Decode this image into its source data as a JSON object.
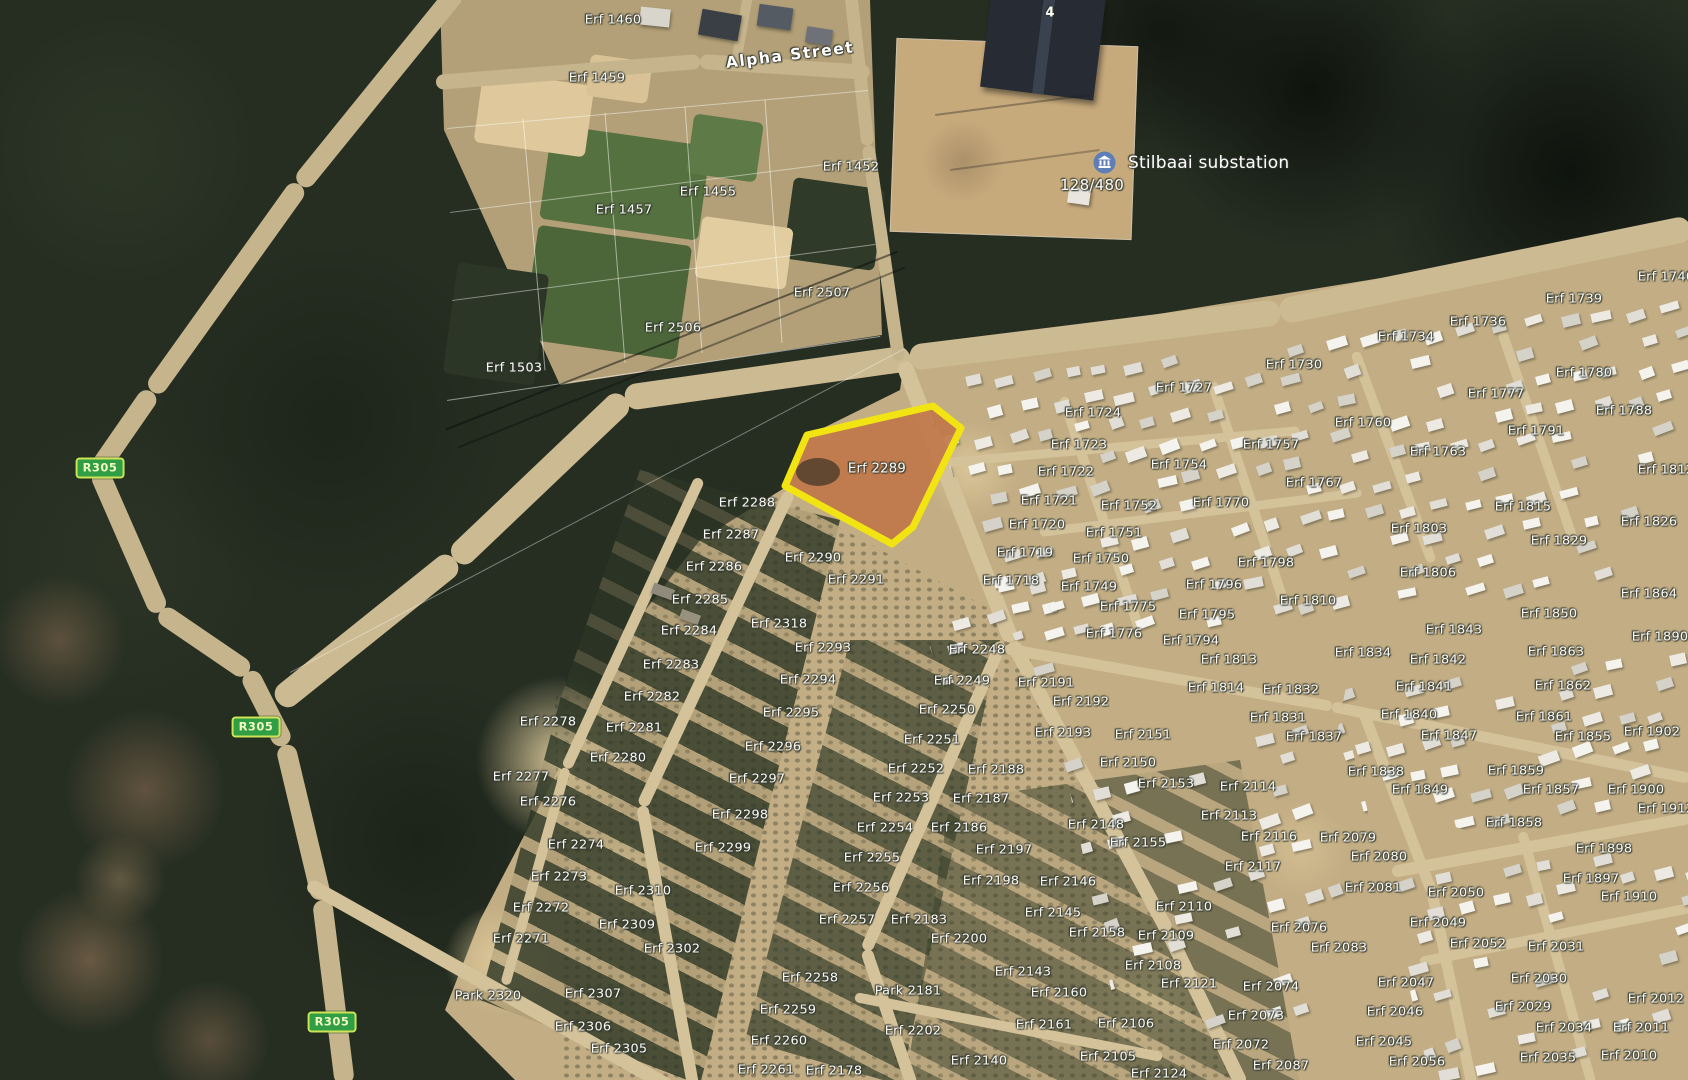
{
  "map": {
    "streets": {
      "alpha": "Alpha Street"
    },
    "poi": {
      "substation_name": "Stilbaai substation",
      "substation_code": "128/480",
      "building_number": "4"
    },
    "route_shields": [
      {
        "label": "R305",
        "x": 100,
        "y": 468
      },
      {
        "label": "R305",
        "x": 256,
        "y": 727
      },
      {
        "label": "R305",
        "x": 332,
        "y": 1022
      }
    ],
    "highlight": {
      "label": "Erf 2289",
      "x": 877,
      "y": 469,
      "outline": "#f2e313",
      "points": "785,486 807,435 933,406 961,428 913,527 892,544"
    },
    "labels": [
      {
        "t": "Erf 1460",
        "x": 613,
        "y": 20
      },
      {
        "t": "Erf 1459",
        "x": 597,
        "y": 78
      },
      {
        "t": "Erf 1452",
        "x": 851,
        "y": 167
      },
      {
        "t": "Erf 1455",
        "x": 708,
        "y": 192
      },
      {
        "t": "Erf 1457",
        "x": 624,
        "y": 210
      },
      {
        "t": "Erf 2507",
        "x": 822,
        "y": 293
      },
      {
        "t": "Erf 2506",
        "x": 673,
        "y": 328
      },
      {
        "t": "Erf 1503",
        "x": 514,
        "y": 368
      },
      {
        "t": "Erf 2288",
        "x": 747,
        "y": 503
      },
      {
        "t": "Erf 2287",
        "x": 731,
        "y": 535
      },
      {
        "t": "Erf 2286",
        "x": 714,
        "y": 567
      },
      {
        "t": "Erf 2285",
        "x": 700,
        "y": 600
      },
      {
        "t": "Erf 2284",
        "x": 689,
        "y": 631
      },
      {
        "t": "Erf 2283",
        "x": 671,
        "y": 665
      },
      {
        "t": "Erf 2282",
        "x": 652,
        "y": 697
      },
      {
        "t": "Erf 2281",
        "x": 634,
        "y": 728
      },
      {
        "t": "Erf 2280",
        "x": 618,
        "y": 758
      },
      {
        "t": "Erf 2278",
        "x": 548,
        "y": 722
      },
      {
        "t": "Erf 2277",
        "x": 521,
        "y": 777
      },
      {
        "t": "Erf 2276",
        "x": 548,
        "y": 802
      },
      {
        "t": "Erf 2274",
        "x": 576,
        "y": 845
      },
      {
        "t": "Erf 2273",
        "x": 559,
        "y": 877
      },
      {
        "t": "Erf 2272",
        "x": 541,
        "y": 908
      },
      {
        "t": "Erf 2271",
        "x": 521,
        "y": 939
      },
      {
        "t": "Park 2320",
        "x": 488,
        "y": 996
      },
      {
        "t": "Erf 2310",
        "x": 643,
        "y": 891
      },
      {
        "t": "Erf 2309",
        "x": 627,
        "y": 925
      },
      {
        "t": "Erf 2302",
        "x": 672,
        "y": 949
      },
      {
        "t": "Erf 2307",
        "x": 593,
        "y": 994
      },
      {
        "t": "Erf 2306",
        "x": 583,
        "y": 1027
      },
      {
        "t": "Erf 2305",
        "x": 619,
        "y": 1049
      },
      {
        "t": "Erf 2290",
        "x": 813,
        "y": 558
      },
      {
        "t": "Erf 2291",
        "x": 856,
        "y": 580
      },
      {
        "t": "Erf 2318",
        "x": 779,
        "y": 624
      },
      {
        "t": "Erf 2293",
        "x": 823,
        "y": 648
      },
      {
        "t": "Erf 2294",
        "x": 808,
        "y": 680
      },
      {
        "t": "Erf 2295",
        "x": 791,
        "y": 713
      },
      {
        "t": "Erf 2296",
        "x": 773,
        "y": 747
      },
      {
        "t": "Erf 2297",
        "x": 757,
        "y": 779
      },
      {
        "t": "Erf 2298",
        "x": 740,
        "y": 815
      },
      {
        "t": "Erf 2299",
        "x": 723,
        "y": 848
      },
      {
        "t": "Erf 2248",
        "x": 977,
        "y": 650
      },
      {
        "t": "Erf 2249",
        "x": 962,
        "y": 681
      },
      {
        "t": "Erf 2250",
        "x": 947,
        "y": 710
      },
      {
        "t": "Erf 2251",
        "x": 932,
        "y": 740
      },
      {
        "t": "Erf 2252",
        "x": 916,
        "y": 769
      },
      {
        "t": "Erf 2253",
        "x": 901,
        "y": 798
      },
      {
        "t": "Erf 2254",
        "x": 885,
        "y": 828
      },
      {
        "t": "Erf 2255",
        "x": 872,
        "y": 858
      },
      {
        "t": "Erf 2256",
        "x": 861,
        "y": 888
      },
      {
        "t": "Erf 2257",
        "x": 847,
        "y": 920
      },
      {
        "t": "Erf 2183",
        "x": 919,
        "y": 920
      },
      {
        "t": "Erf 2200",
        "x": 959,
        "y": 939
      },
      {
        "t": "Park 2181",
        "x": 908,
        "y": 991
      },
      {
        "t": "Erf 2202",
        "x": 913,
        "y": 1031
      },
      {
        "t": "Erf 2258",
        "x": 810,
        "y": 978
      },
      {
        "t": "Erf 2259",
        "x": 788,
        "y": 1010
      },
      {
        "t": "Erf 2260",
        "x": 779,
        "y": 1041
      },
      {
        "t": "Erf 2261",
        "x": 766,
        "y": 1070
      },
      {
        "t": "Erf 2178",
        "x": 834,
        "y": 1071
      },
      {
        "t": "Erf 2140",
        "x": 979,
        "y": 1061
      },
      {
        "t": "Erf 2143",
        "x": 1023,
        "y": 972
      },
      {
        "t": "Erf 2145",
        "x": 1053,
        "y": 913
      },
      {
        "t": "Erf 2146",
        "x": 1068,
        "y": 882
      },
      {
        "t": "Erf 2148",
        "x": 1096,
        "y": 825
      },
      {
        "t": "Erf 2155",
        "x": 1138,
        "y": 843
      },
      {
        "t": "Erf 2158",
        "x": 1097,
        "y": 933
      },
      {
        "t": "Erf 2160",
        "x": 1059,
        "y": 993
      },
      {
        "t": "Erf 2161",
        "x": 1044,
        "y": 1025
      },
      {
        "t": "Erf 2197",
        "x": 1004,
        "y": 850
      },
      {
        "t": "Erf 2198",
        "x": 991,
        "y": 881
      },
      {
        "t": "Erf 2186",
        "x": 959,
        "y": 828
      },
      {
        "t": "Erf 2187",
        "x": 981,
        "y": 799
      },
      {
        "t": "Erf 2188",
        "x": 996,
        "y": 770
      },
      {
        "t": "Erf 2191",
        "x": 1046,
        "y": 683
      },
      {
        "t": "Erf 2192",
        "x": 1081,
        "y": 702
      },
      {
        "t": "Erf 2193",
        "x": 1063,
        "y": 733
      },
      {
        "t": "Erf 2150",
        "x": 1128,
        "y": 763
      },
      {
        "t": "Erf 2151",
        "x": 1143,
        "y": 735
      },
      {
        "t": "Erf 2153",
        "x": 1166,
        "y": 784
      },
      {
        "t": "Erf 2114",
        "x": 1248,
        "y": 787
      },
      {
        "t": "Erf 2113",
        "x": 1229,
        "y": 816
      },
      {
        "t": "Erf 2116",
        "x": 1269,
        "y": 837
      },
      {
        "t": "Erf 2117",
        "x": 1253,
        "y": 867
      },
      {
        "t": "Erf 2110",
        "x": 1184,
        "y": 907
      },
      {
        "t": "Erf 2109",
        "x": 1166,
        "y": 936
      },
      {
        "t": "Erf 2108",
        "x": 1153,
        "y": 966
      },
      {
        "t": "Erf 2121",
        "x": 1189,
        "y": 984
      },
      {
        "t": "Erf 2124",
        "x": 1159,
        "y": 1074
      },
      {
        "t": "Erf 2105",
        "x": 1108,
        "y": 1057
      },
      {
        "t": "Erf 2106",
        "x": 1126,
        "y": 1024
      },
      {
        "t": "Erf 2076",
        "x": 1299,
        "y": 928
      },
      {
        "t": "Erf 2083",
        "x": 1339,
        "y": 948
      },
      {
        "t": "Erf 2074",
        "x": 1271,
        "y": 987
      },
      {
        "t": "Erf 2073",
        "x": 1256,
        "y": 1016
      },
      {
        "t": "Erf 2072",
        "x": 1241,
        "y": 1045
      },
      {
        "t": "Erf 2087",
        "x": 1281,
        "y": 1066
      },
      {
        "t": "Erf 2079",
        "x": 1348,
        "y": 838
      },
      {
        "t": "Erf 2080",
        "x": 1379,
        "y": 857
      },
      {
        "t": "Erf 2081",
        "x": 1373,
        "y": 888
      },
      {
        "t": "Erf 2047",
        "x": 1406,
        "y": 983
      },
      {
        "t": "Erf 2046",
        "x": 1395,
        "y": 1012
      },
      {
        "t": "Erf 2045",
        "x": 1384,
        "y": 1042
      },
      {
        "t": "Erf 2056",
        "x": 1417,
        "y": 1062
      },
      {
        "t": "Erf 2050",
        "x": 1456,
        "y": 893
      },
      {
        "t": "Erf 2049",
        "x": 1438,
        "y": 923
      },
      {
        "t": "Erf 2052",
        "x": 1478,
        "y": 944
      },
      {
        "t": "Erf 2031",
        "x": 1556,
        "y": 947
      },
      {
        "t": "Erf 2030",
        "x": 1539,
        "y": 979
      },
      {
        "t": "Erf 2029",
        "x": 1523,
        "y": 1007
      },
      {
        "t": "Erf 2034",
        "x": 1564,
        "y": 1028
      },
      {
        "t": "Erf 2035",
        "x": 1548,
        "y": 1058
      },
      {
        "t": "Erf 2011",
        "x": 1641,
        "y": 1028
      },
      {
        "t": "Erf 2010",
        "x": 1629,
        "y": 1056
      },
      {
        "t": "Erf 2012",
        "x": 1656,
        "y": 999
      },
      {
        "t": "Erf 1727",
        "x": 1184,
        "y": 388
      },
      {
        "t": "Erf 1724",
        "x": 1093,
        "y": 413
      },
      {
        "t": "Erf 1723",
        "x": 1079,
        "y": 445
      },
      {
        "t": "Erf 1722",
        "x": 1066,
        "y": 472
      },
      {
        "t": "Erf 1721",
        "x": 1049,
        "y": 501
      },
      {
        "t": "Erf 1720",
        "x": 1037,
        "y": 525
      },
      {
        "t": "Erf 1719",
        "x": 1025,
        "y": 553
      },
      {
        "t": "Erf 1718",
        "x": 1011,
        "y": 581
      },
      {
        "t": "Erf 1757",
        "x": 1271,
        "y": 445
      },
      {
        "t": "Erf 1754",
        "x": 1179,
        "y": 465
      },
      {
        "t": "Erf 1752",
        "x": 1129,
        "y": 506
      },
      {
        "t": "Erf 1751",
        "x": 1114,
        "y": 533
      },
      {
        "t": "Erf 1750",
        "x": 1101,
        "y": 559
      },
      {
        "t": "Erf 1749",
        "x": 1089,
        "y": 587
      },
      {
        "t": "Erf 1775",
        "x": 1128,
        "y": 607
      },
      {
        "t": "Erf 1776",
        "x": 1114,
        "y": 634
      },
      {
        "t": "Erf 1767",
        "x": 1314,
        "y": 483
      },
      {
        "t": "Erf 1770",
        "x": 1221,
        "y": 503
      },
      {
        "t": "Erf 1798",
        "x": 1266,
        "y": 563
      },
      {
        "t": "Erf 1796",
        "x": 1214,
        "y": 585
      },
      {
        "t": "Erf 1795",
        "x": 1207,
        "y": 615
      },
      {
        "t": "Erf 1794",
        "x": 1191,
        "y": 641
      },
      {
        "t": "Erf 1810",
        "x": 1308,
        "y": 601
      },
      {
        "t": "Erf 1813",
        "x": 1229,
        "y": 660
      },
      {
        "t": "Erf 1814",
        "x": 1216,
        "y": 688
      },
      {
        "t": "Erf 1832",
        "x": 1291,
        "y": 690
      },
      {
        "t": "Erf 1831",
        "x": 1278,
        "y": 718
      },
      {
        "t": "Erf 1837",
        "x": 1314,
        "y": 737
      },
      {
        "t": "Erf 1834",
        "x": 1363,
        "y": 653
      },
      {
        "t": "Erf 1736",
        "x": 1478,
        "y": 322
      },
      {
        "t": "Erf 1734",
        "x": 1406,
        "y": 337
      },
      {
        "t": "Erf 1739",
        "x": 1574,
        "y": 299
      },
      {
        "t": "Erf 1730",
        "x": 1294,
        "y": 365
      },
      {
        "t": "Erf 1760",
        "x": 1363,
        "y": 423
      },
      {
        "t": "Erf 1780",
        "x": 1584,
        "y": 373
      },
      {
        "t": "Erf 1777",
        "x": 1496,
        "y": 394
      },
      {
        "t": "Erf 1788",
        "x": 1624,
        "y": 411
      },
      {
        "t": "Erf 1791",
        "x": 1536,
        "y": 431
      },
      {
        "t": "Erf 1763",
        "x": 1438,
        "y": 452
      },
      {
        "t": "Erf 1815",
        "x": 1523,
        "y": 507
      },
      {
        "t": "Erf 1803",
        "x": 1419,
        "y": 529
      },
      {
        "t": "Erf 1826",
        "x": 1649,
        "y": 522
      },
      {
        "t": "Erf 1829",
        "x": 1559,
        "y": 541
      },
      {
        "t": "Erf 1806",
        "x": 1428,
        "y": 573
      },
      {
        "t": "Erf 1843",
        "x": 1454,
        "y": 630
      },
      {
        "t": "Erf 1842",
        "x": 1438,
        "y": 660
      },
      {
        "t": "Erf 1841",
        "x": 1424,
        "y": 687
      },
      {
        "t": "Erf 1840",
        "x": 1409,
        "y": 715
      },
      {
        "t": "Erf 1847",
        "x": 1449,
        "y": 736
      },
      {
        "t": "Erf 1838",
        "x": 1376,
        "y": 772
      },
      {
        "t": "Erf 1849",
        "x": 1420,
        "y": 790
      },
      {
        "t": "Erf 1863",
        "x": 1556,
        "y": 652
      },
      {
        "t": "Erf 1862",
        "x": 1563,
        "y": 686
      },
      {
        "t": "Erf 1861",
        "x": 1544,
        "y": 717
      },
      {
        "t": "Erf 1855",
        "x": 1583,
        "y": 737
      },
      {
        "t": "Erf 1859",
        "x": 1516,
        "y": 771
      },
      {
        "t": "Erf 1857",
        "x": 1551,
        "y": 790
      },
      {
        "t": "Erf 1850",
        "x": 1549,
        "y": 614
      },
      {
        "t": "Erf 1864",
        "x": 1649,
        "y": 594
      },
      {
        "t": "Erf 1890",
        "x": 1660,
        "y": 637
      },
      {
        "t": "Erf 1902",
        "x": 1652,
        "y": 732
      },
      {
        "t": "Erf 1900",
        "x": 1636,
        "y": 790
      },
      {
        "t": "Erf 1898",
        "x": 1604,
        "y": 849
      },
      {
        "t": "Erf 1897",
        "x": 1591,
        "y": 879
      },
      {
        "t": "Erf 1910",
        "x": 1629,
        "y": 897
      },
      {
        "t": "Erf 1858",
        "x": 1514,
        "y": 823
      },
      {
        "t": "Erf 1912",
        "x": 1666,
        "y": 809
      },
      {
        "t": "Erf 1812",
        "x": 1666,
        "y": 470
      },
      {
        "t": "Erf 1740",
        "x": 1666,
        "y": 277
      }
    ]
  },
  "colors": {
    "highlight_outline": "#f2e313",
    "highlight_fill": "#c07748",
    "shield_fill": "#2f9e44",
    "shield_border": "#cfe25a",
    "shield_text": "#f2f7c0",
    "label_text": "#fcfcf8"
  }
}
